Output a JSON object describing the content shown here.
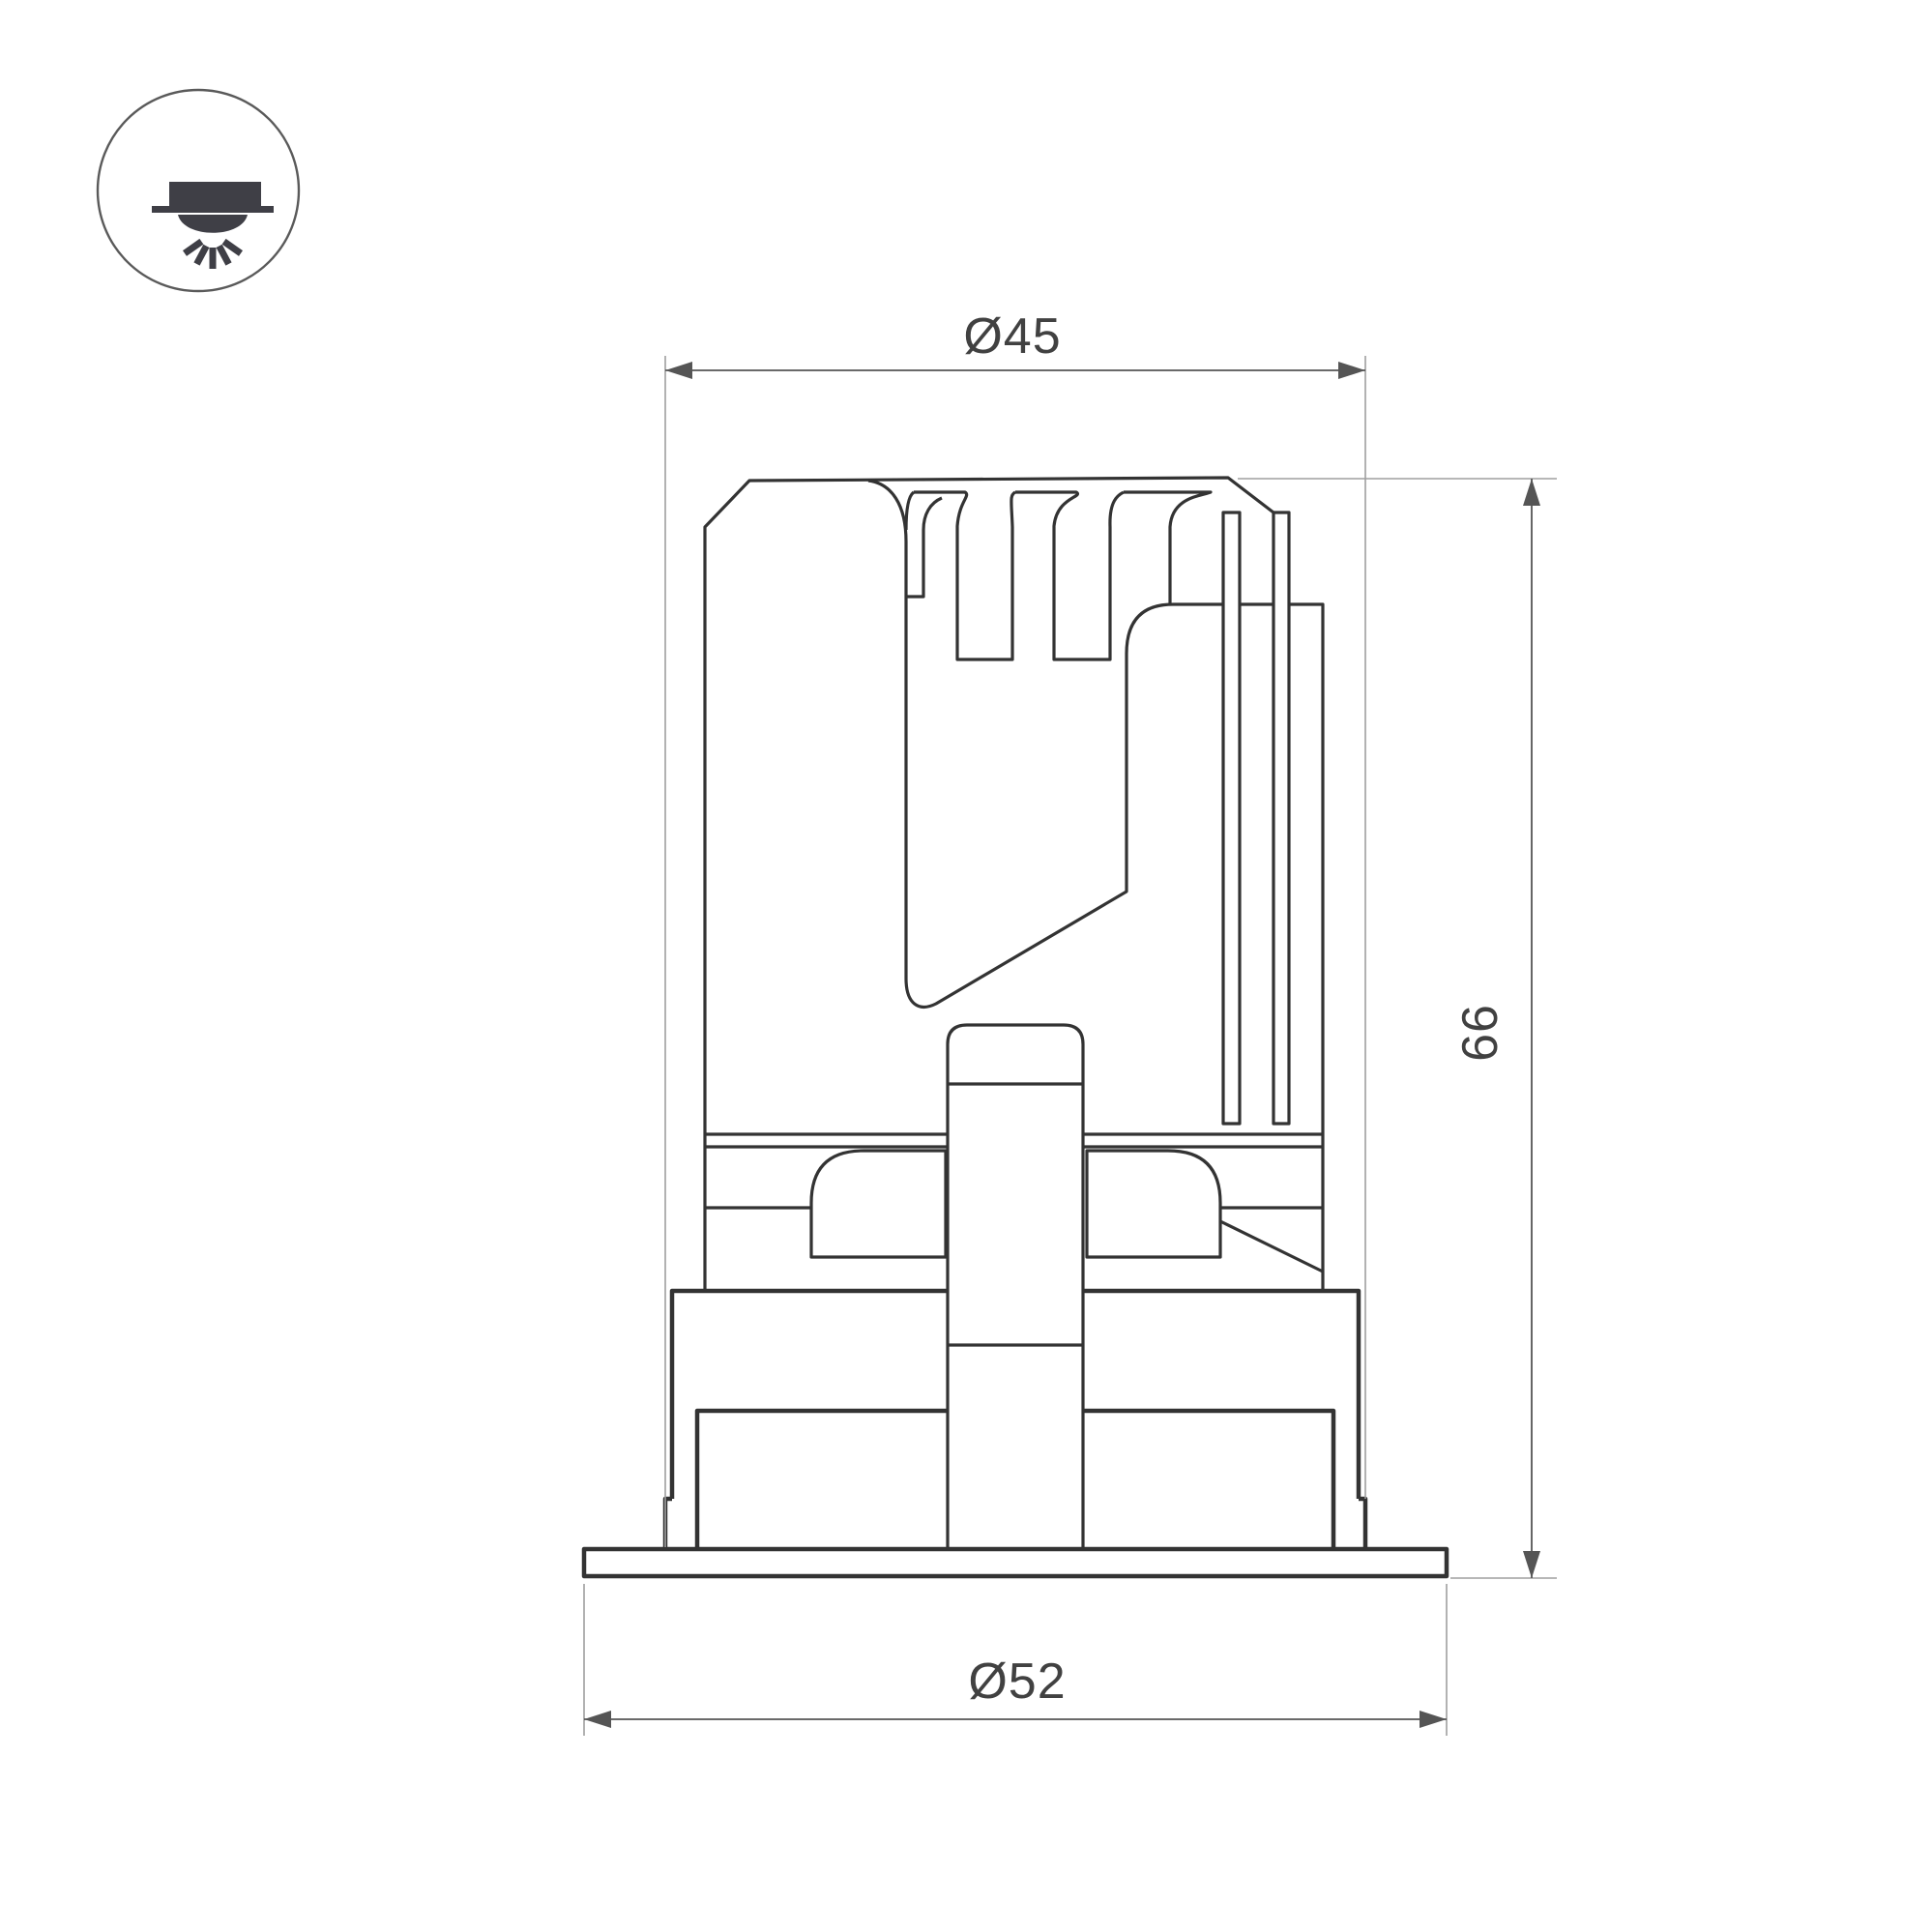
{
  "drawing": {
    "title": "recessed-downlight-section-drawing",
    "icon": {
      "name": "recessed-downlight-icon"
    },
    "dimensions": {
      "body_diameter": {
        "label": "Ø45",
        "value": 45
      },
      "height": {
        "label": "66",
        "value": 66
      },
      "flange_diameter": {
        "label": "Ø52",
        "value": 52
      }
    }
  },
  "colors": {
    "line": "#333333",
    "dimension": "#555555",
    "extension": "#9f9f9f",
    "text": "#414141",
    "background": "#ffffff",
    "icon": "#3f3f46"
  }
}
